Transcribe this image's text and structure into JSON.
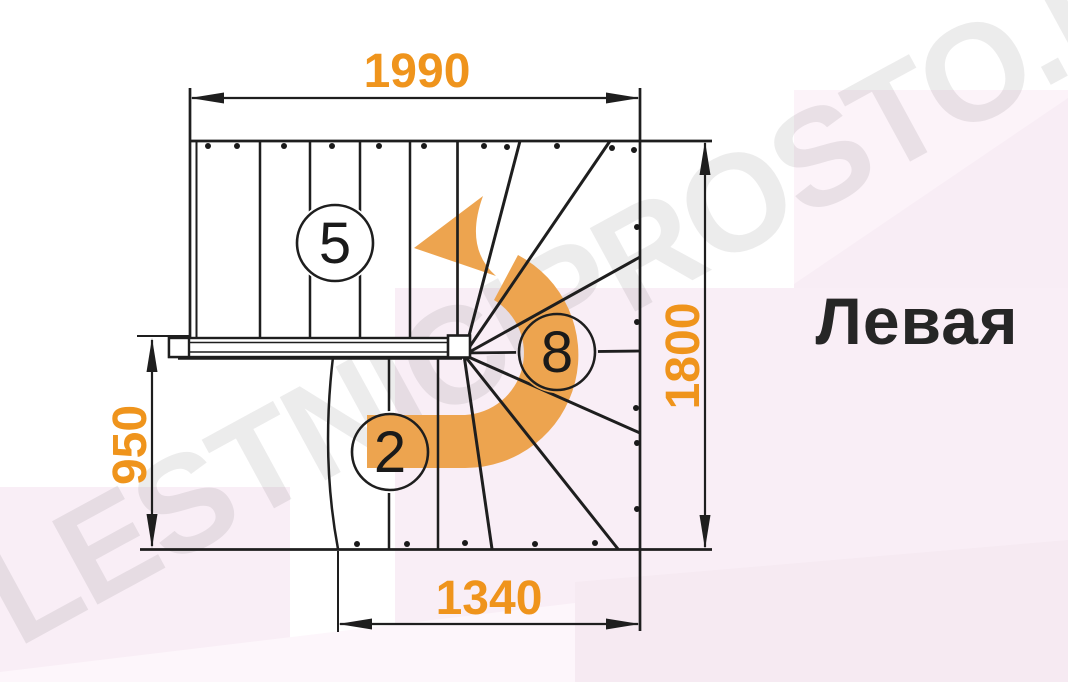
{
  "title_label": "Левая",
  "watermark": "LESTNICIPROSTO.RU",
  "dimensions": {
    "top": "1990",
    "right": "1800",
    "left": "950",
    "bottom": "1340"
  },
  "step_counts": {
    "upper_flight": "5",
    "winder": "8",
    "lower_flight": "2"
  },
  "colors": {
    "dimension_text": "#ef941c",
    "arrow": "#eda44f",
    "line": "#1e1e1e",
    "label_text": "#262626",
    "bg_pink": "#f9eef6",
    "bg_pink_light": "#fcf3f9",
    "bg_pink_deep": "#f6eaf2"
  }
}
